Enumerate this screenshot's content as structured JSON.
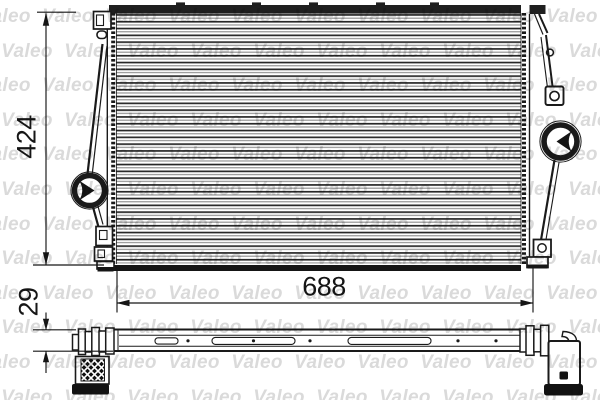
{
  "drawing": {
    "dimensions": {
      "height_mm": "424",
      "width_mm": "688",
      "depth_mm": "29"
    },
    "line_color": "#1a1a1a",
    "background": "#ffffff"
  },
  "watermark": {
    "text": "Valeo",
    "color": "#dadada"
  }
}
